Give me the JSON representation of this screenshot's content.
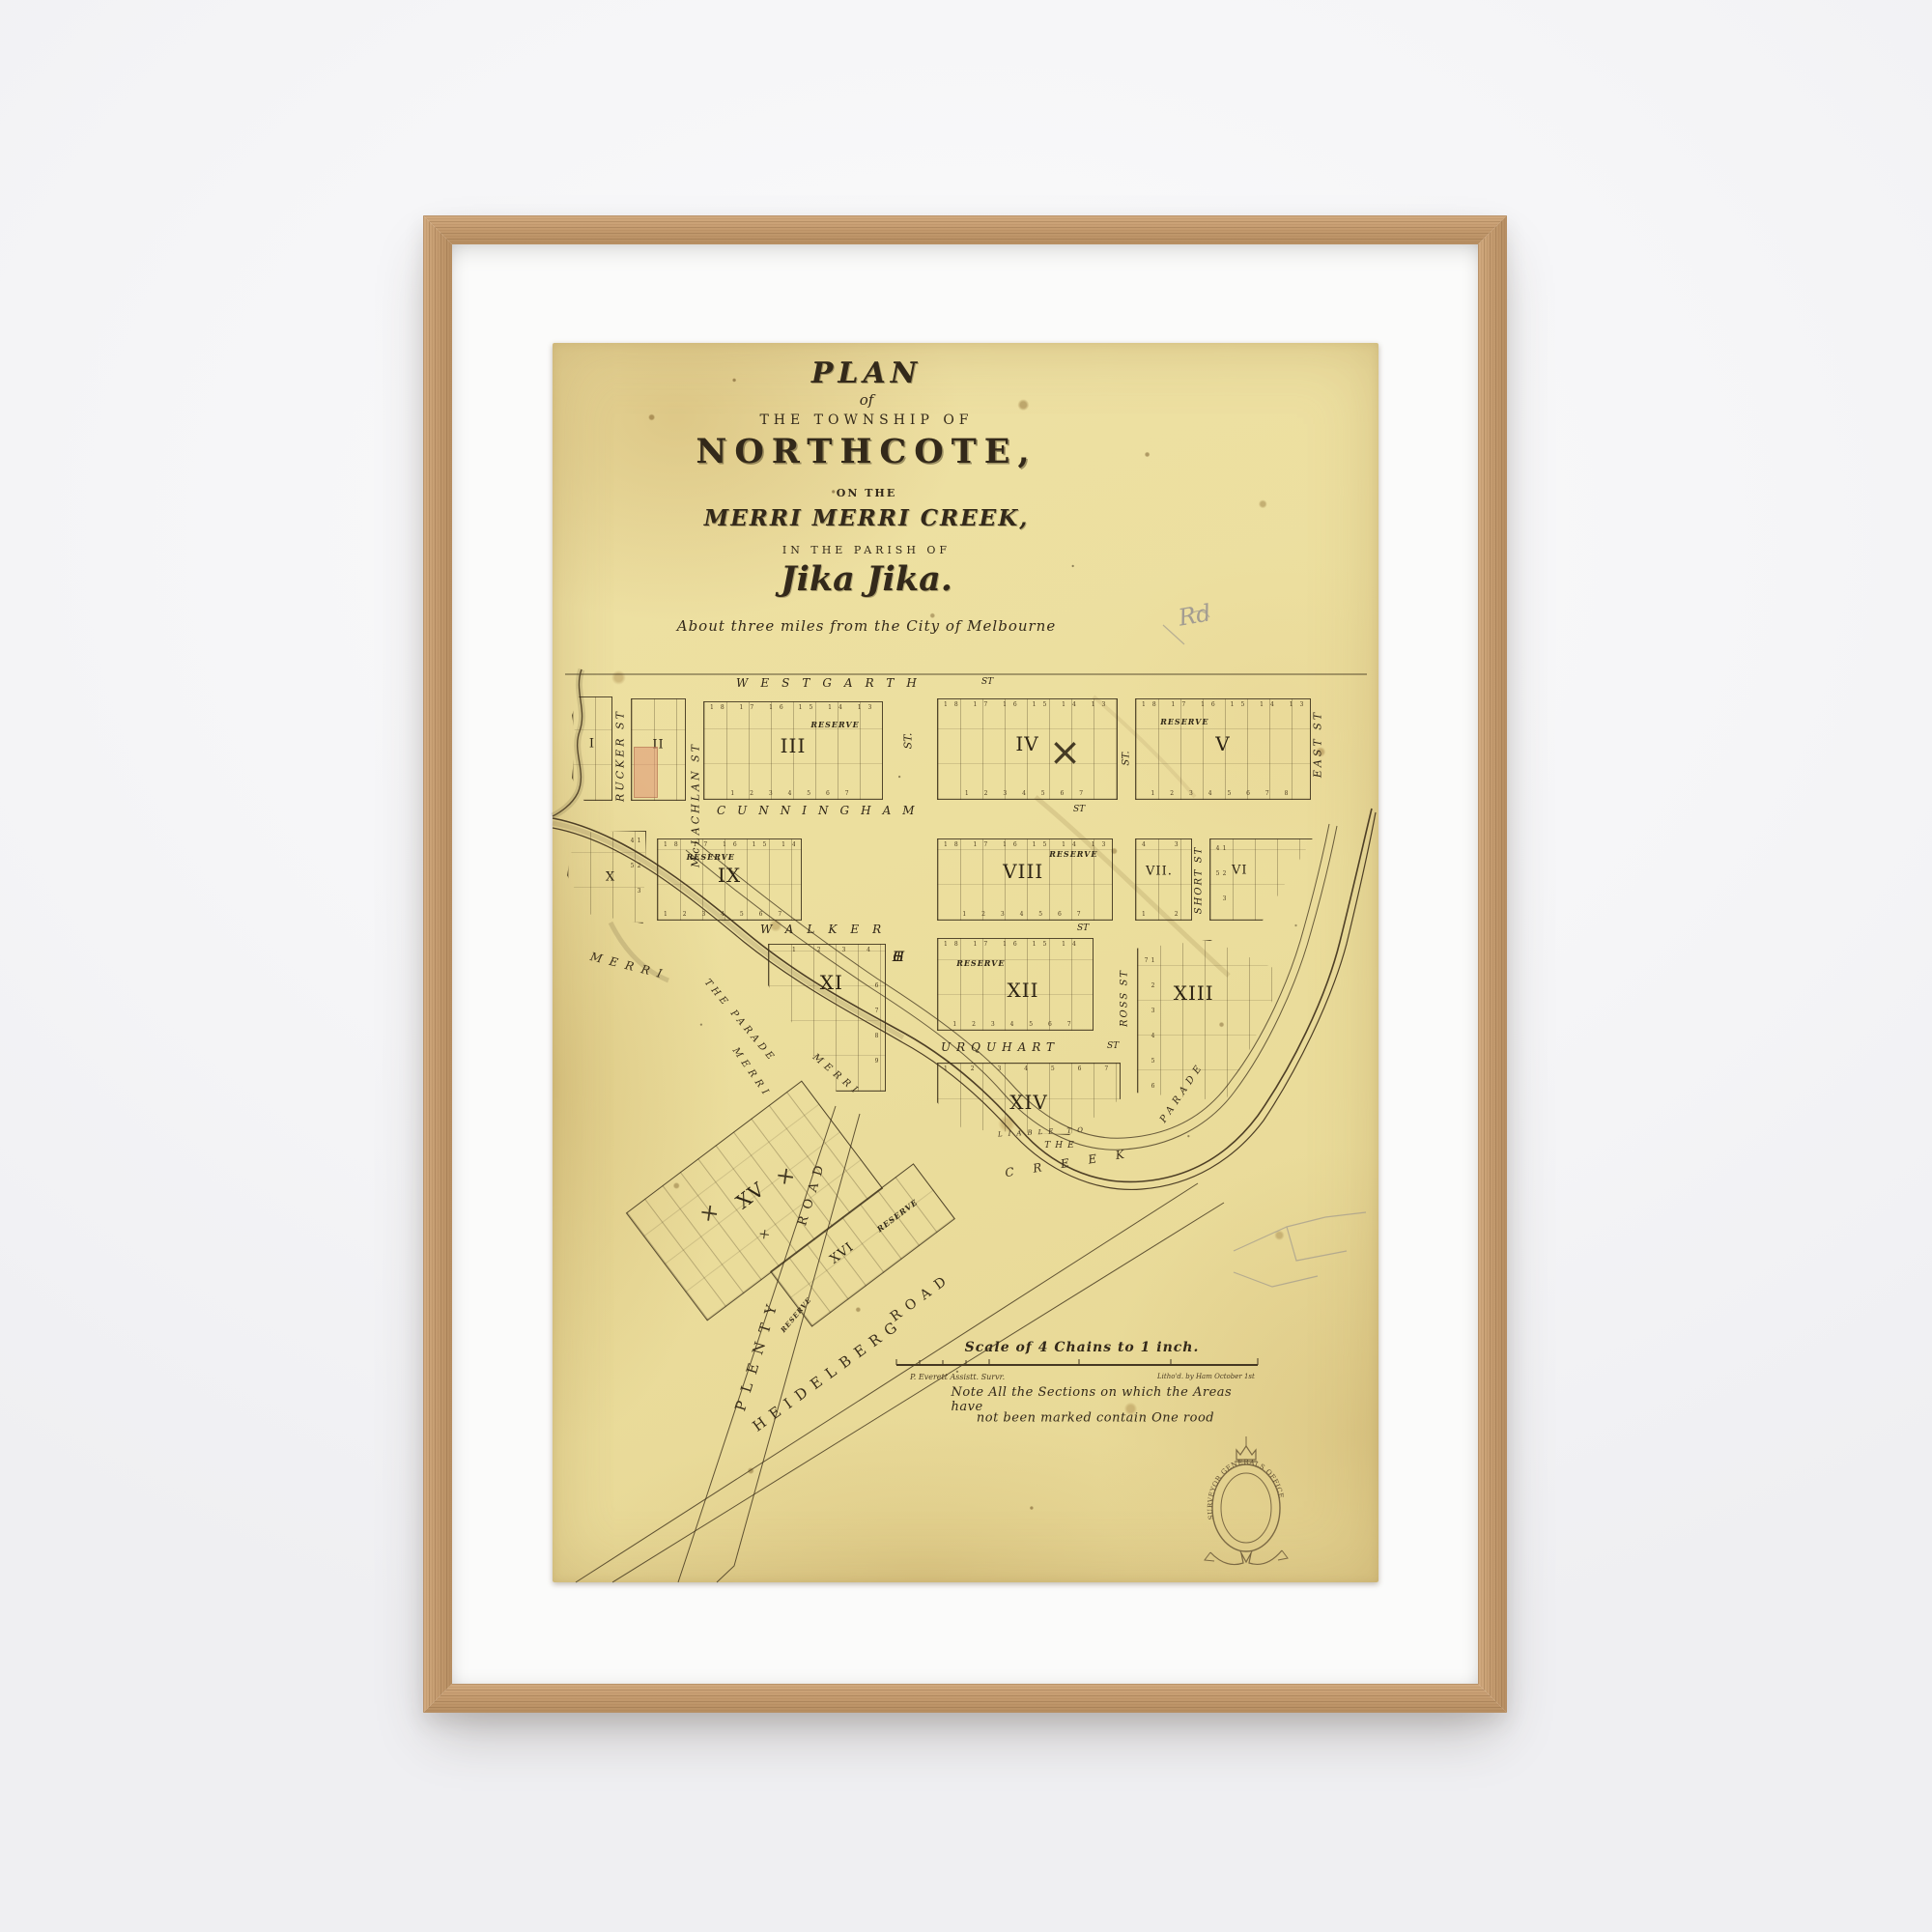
{
  "map": {
    "title": {
      "plan": "PLAN",
      "of": "of",
      "township": "THE TOWNSHIP OF",
      "name": "NORTHCOTE,",
      "on_the": "ON THE",
      "creek": "MERRI MERRI CREEK,",
      "parish": "IN THE PARISH OF",
      "jika": "Jika Jika.",
      "subtitle": "About three miles from the City of Melbourne"
    },
    "annotations": {
      "pencil_note": "Rd"
    },
    "streets": {
      "westgarth": {
        "name": "WESTGARTH",
        "abbr": "ST"
      },
      "cunningham": {
        "name": "CUNNINGHAM",
        "abbr": "ST"
      },
      "walker": {
        "name": "WALKER",
        "abbr": "ST"
      },
      "urquhart": {
        "name": "URQUHART",
        "abbr": "ST"
      },
      "rucker": "RUCKER ST",
      "mclachlan": "McLACHLAN ST",
      "high": {
        "abbr": "ST.",
        "letters": [
          "H",
          "I",
          "G",
          "H"
        ]
      },
      "mid_abbr": "ST.",
      "short_st": "SHORT ST",
      "east": "EAST ST",
      "ross": "ROSS ST"
    },
    "blocks": [
      {
        "numeral": "I"
      },
      {
        "numeral": "II"
      },
      {
        "numeral": "III",
        "reserve": "RESERVE",
        "top_numbers": "18 17 16 15 14 13 12",
        "bottom_numbers": "1 2 3 4 5 6 7"
      },
      {
        "numeral": "IV",
        "top_numbers": "18 17 16 15 14 13 12",
        "bottom_numbers": "1 2 3 4 5 6 7"
      },
      {
        "numeral": "V",
        "reserve": "RESERVE",
        "top_numbers": "18 17 16 15 14 13 12",
        "bottom_numbers": "1 2 3 4 5 6 7 8"
      },
      {
        "numeral": "X",
        "right_numbers": "1 2 3 4 5"
      },
      {
        "numeral": "IX",
        "reserve": "RESERVE",
        "top_numbers": "18 17 16 15 14 13 12",
        "bottom_numbers": "1 2 3 4 5 6 7 8"
      },
      {
        "numeral": "VIII",
        "reserve": "RESERVE",
        "top_numbers": "18 17 16 15 14 13 12",
        "bottom_numbers": "1 2 3 4 5 6 7"
      },
      {
        "numeral": "VII.",
        "top_numbers": "4 3",
        "bottom_numbers": "1 2"
      },
      {
        "numeral": "VI",
        "left_numbers": "1 2 3 4 5"
      },
      {
        "numeral": "XI",
        "top_numbers": "1 2 3 4 5",
        "right_numbers": "6 7 8 9"
      },
      {
        "numeral": "XII",
        "reserve": "RESERVE",
        "top_numbers": "18 17 16 15 14 13",
        "bottom_numbers": "1 2 3 4 5 6 7"
      },
      {
        "numeral": "XIII",
        "left_numbers": "1 2 3 4 5 6 7"
      },
      {
        "numeral": "XIV",
        "top_numbers": "1 2 3 4 5 6 7 8 9 10"
      },
      {
        "numeral": "XV"
      },
      {
        "numeral": "XVI",
        "reserve": "RESERVE"
      }
    ],
    "creek_labels": {
      "merri_1": "MERRI",
      "the_parade": "THE PARADE",
      "merri_2": "MERRI",
      "merri_3": "MERRI",
      "creek_word": "CREEK",
      "the_east": "THE",
      "parade_east": "PARADE",
      "liable": "LIABLE TO"
    },
    "roads": {
      "plenty_name": "PLENTY",
      "plenty_road": "ROAD",
      "heidelberg_name": "HEIDELBERG",
      "heidelberg_road": "ROAD"
    },
    "footer": {
      "scale_label": "Scale of 4 Chains to 1 inch.",
      "surveyor": "P. Everett Assistt. Survr.",
      "litho": "Litho'd. by Ham  October 1st",
      "note_line1": "Note   All the Sections on which the Areas have",
      "note_line2": "not been marked  contain  One rood",
      "seal_text": "SURVEYOR  GENERALS  OFFICE"
    }
  },
  "colors": {
    "paper": "#ecdf9e",
    "ink": "#33291a",
    "frame_wood": "#c59c70",
    "mat": "#fbfbfa",
    "highlight_lot": "#df9373"
  }
}
